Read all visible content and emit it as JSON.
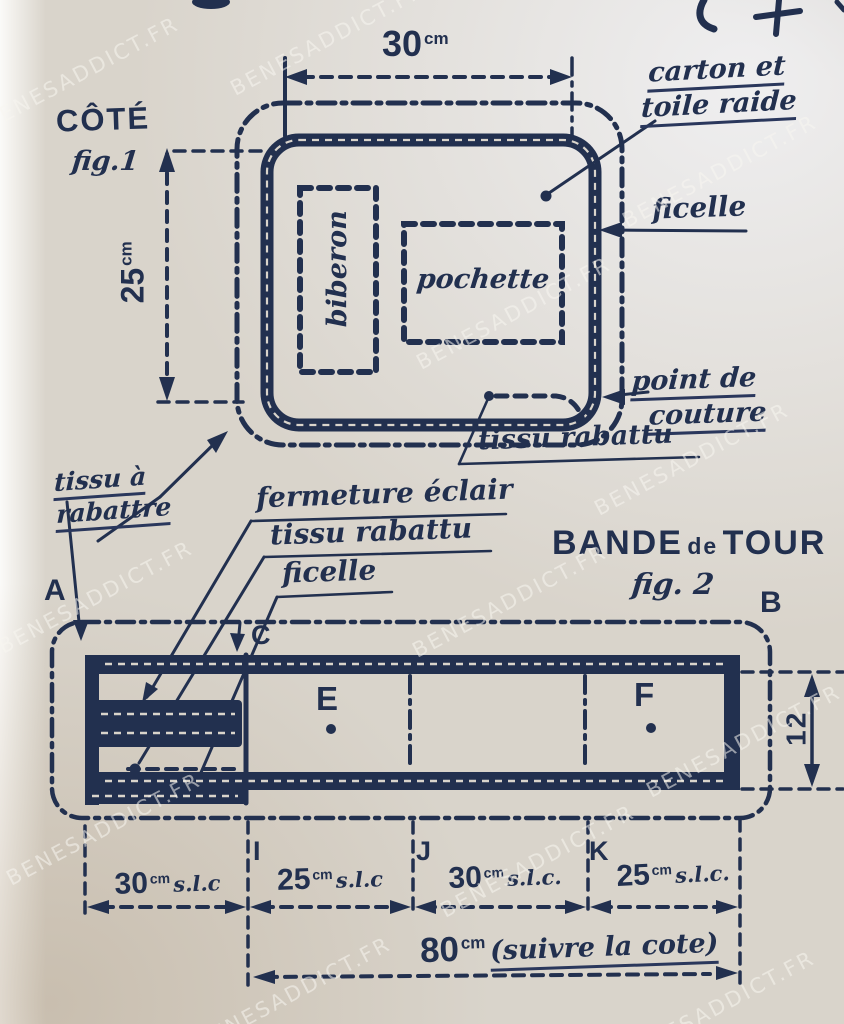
{
  "watermark": {
    "text": "BENESADDICT.FR"
  },
  "palette": {
    "ink": "#22304f",
    "paper": "#d9d4cb"
  },
  "fig1": {
    "title": "CÔTÉ",
    "fig": "fig.1",
    "width_dim": {
      "value": "30",
      "unit": "cm"
    },
    "height_dim": {
      "value": "25",
      "unit": "cm"
    },
    "carton_line1": "carton et",
    "carton_line2": "toile raide",
    "ficelle": "ficelle",
    "biberon": "biberon",
    "pochette": "pochette",
    "couture_line1": "point de",
    "couture_line2": "couture",
    "tissu_rabattu": "tissu rabattu",
    "tissu_a_line1": "tissu à",
    "tissu_a_line2": "rabattre"
  },
  "callouts": {
    "fermeture": "fermeture éclair",
    "tissu_rabattu": "tissu rabattu",
    "ficelle": "ficelle"
  },
  "fig2": {
    "title_1": "BANDE",
    "title_2": "de",
    "title_3": "TOUR",
    "fig": "fig. 2",
    "pt_a": "A",
    "pt_b": "B",
    "pt_c": "C",
    "pt_e": "E",
    "pt_f": "F",
    "pt_i": "I",
    "pt_j": "J",
    "pt_k": "K",
    "height_dim": "12",
    "seg1": {
      "value": "30",
      "unit": "cm",
      "suffix": "s.l.c"
    },
    "seg2": {
      "value": "25",
      "unit": "cm",
      "suffix": "s.l.c"
    },
    "seg3": {
      "value": "30",
      "unit": "cm",
      "suffix": "s.l.c."
    },
    "seg4": {
      "value": "25",
      "unit": "cm",
      "suffix": "s.l.c."
    },
    "total": {
      "value": "80",
      "unit": "cm",
      "suffix": "(suivre la cote)"
    }
  }
}
